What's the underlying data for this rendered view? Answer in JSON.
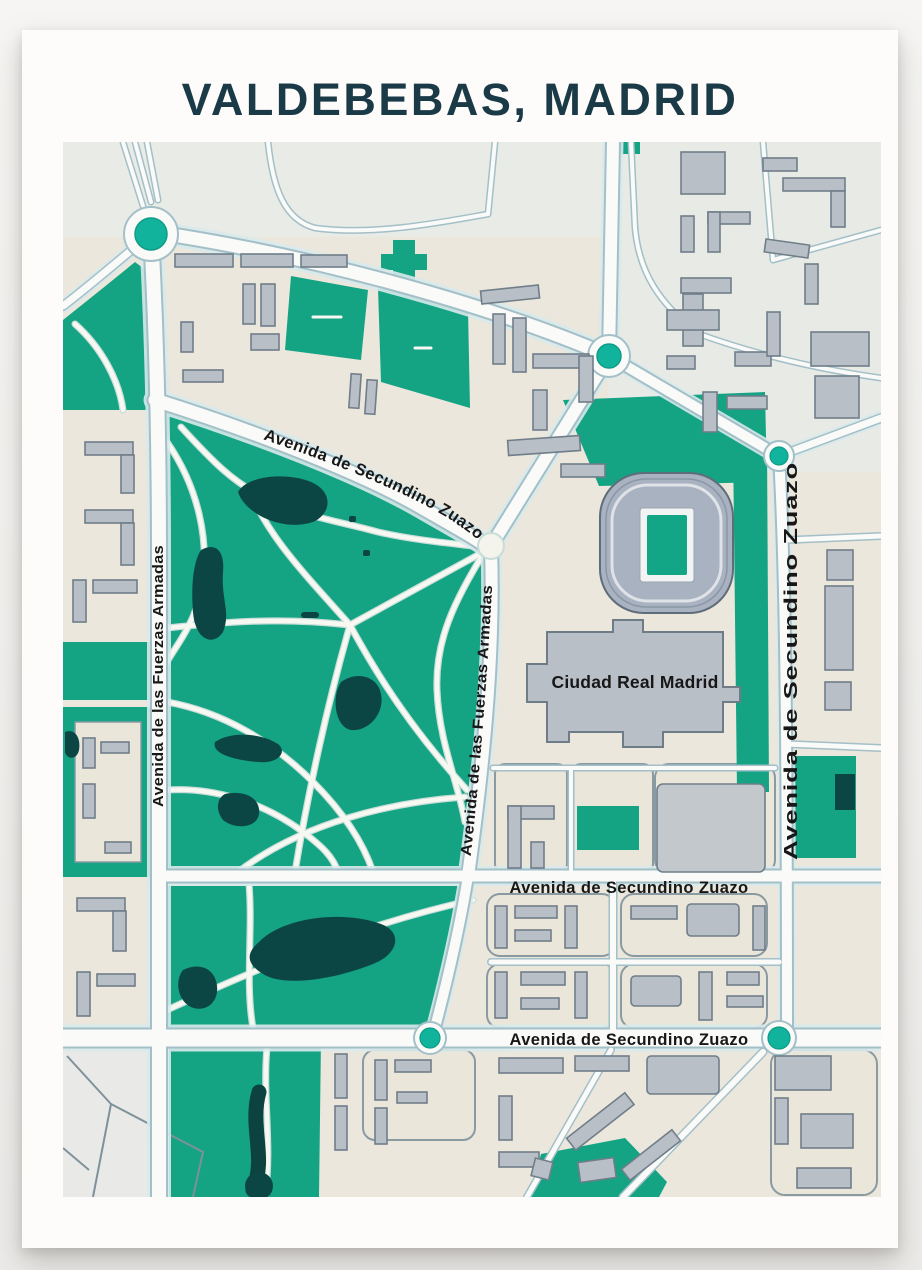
{
  "poster": {
    "title": "VALDEBEBAS, MADRID"
  },
  "labels": {
    "secundino_top": "Avenida de Secundino Zuazo",
    "fuerzas_left": "Avenida de las Fuerzas Armadas",
    "fuerzas_diag": "Avenida de las Fuerzas Armadas",
    "secundino_right": "Avenida de Secundino Zuazo",
    "secundino_mid": "Avenida de Secundino Zuazo",
    "secundino_bottom": "Avenida de Secundino Zuazo",
    "ciudad": "Ciudad Real Madrid"
  },
  "colors": {
    "title_ink": "#1b3a47",
    "park_green": "#14a383",
    "pond_dark": "#0c4644",
    "roundabout_teal": "#12b39c",
    "building_gray": "#b9bfc7",
    "road_white": "#fafbf8",
    "block_beige": "#ebe7dc",
    "label_black": "#171717"
  }
}
